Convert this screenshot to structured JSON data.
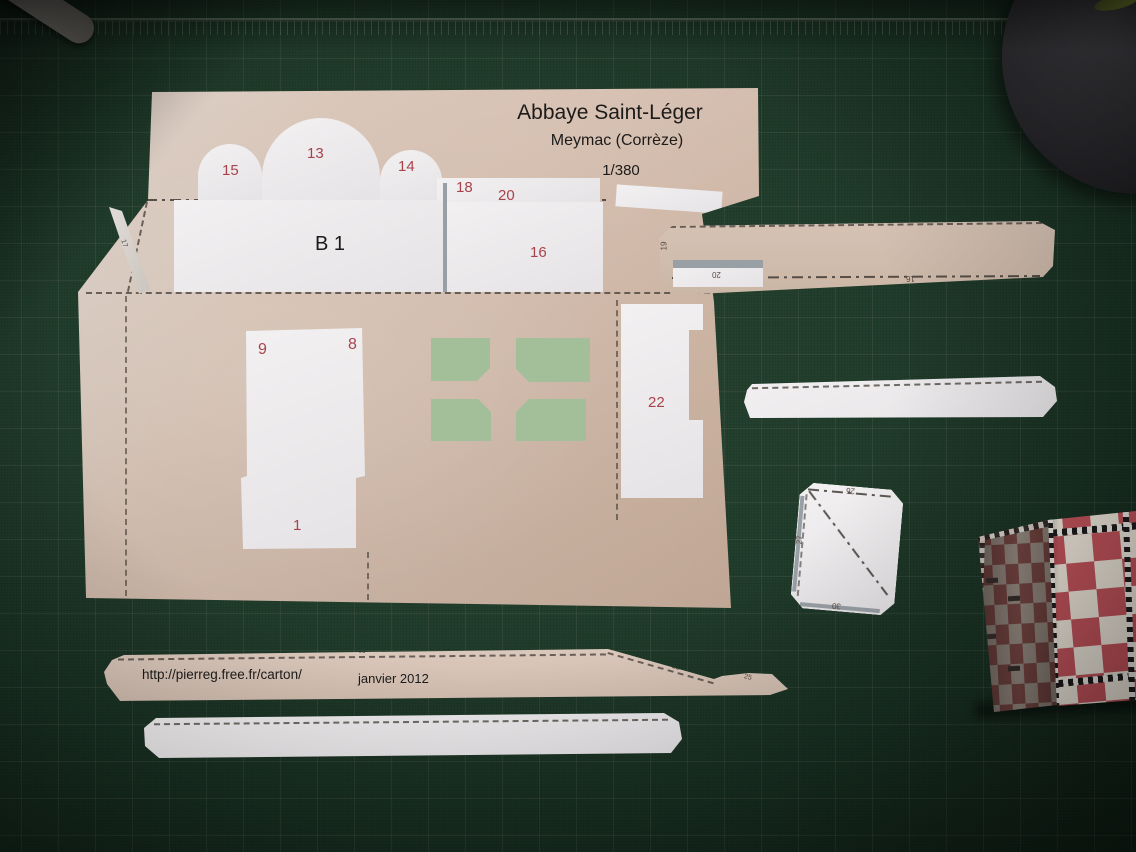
{
  "sheet": {
    "title": "Abbaye Saint-Léger",
    "subtitle": "Meymac (Corrèze)",
    "scale": "1/380",
    "b1": "B 1",
    "n15": "15",
    "n13": "13",
    "n14": "14",
    "n18": "18",
    "n20": "20",
    "n16": "16",
    "n9": "9",
    "n8": "8",
    "n1": "1",
    "n22": "22",
    "n17": "17"
  },
  "long_piece": {
    "n19": "19",
    "n20": "20",
    "n16": "16"
  },
  "square_piece": {
    "n26": "26",
    "n27": "27",
    "n30": "30"
  },
  "url_strip": {
    "url": "http://pierreg.free.fr/carton/",
    "date": "janvier 2012",
    "n21": "21",
    "n23": "23",
    "n25": "25"
  },
  "colors": {
    "mat_green": "#1c3527",
    "sheet_tan": "#d5c0b2",
    "paper_white": "#eceaeb",
    "window_green": "#a2bf9a",
    "number_red": "#a8434c",
    "checker_red": "#bf525a"
  }
}
